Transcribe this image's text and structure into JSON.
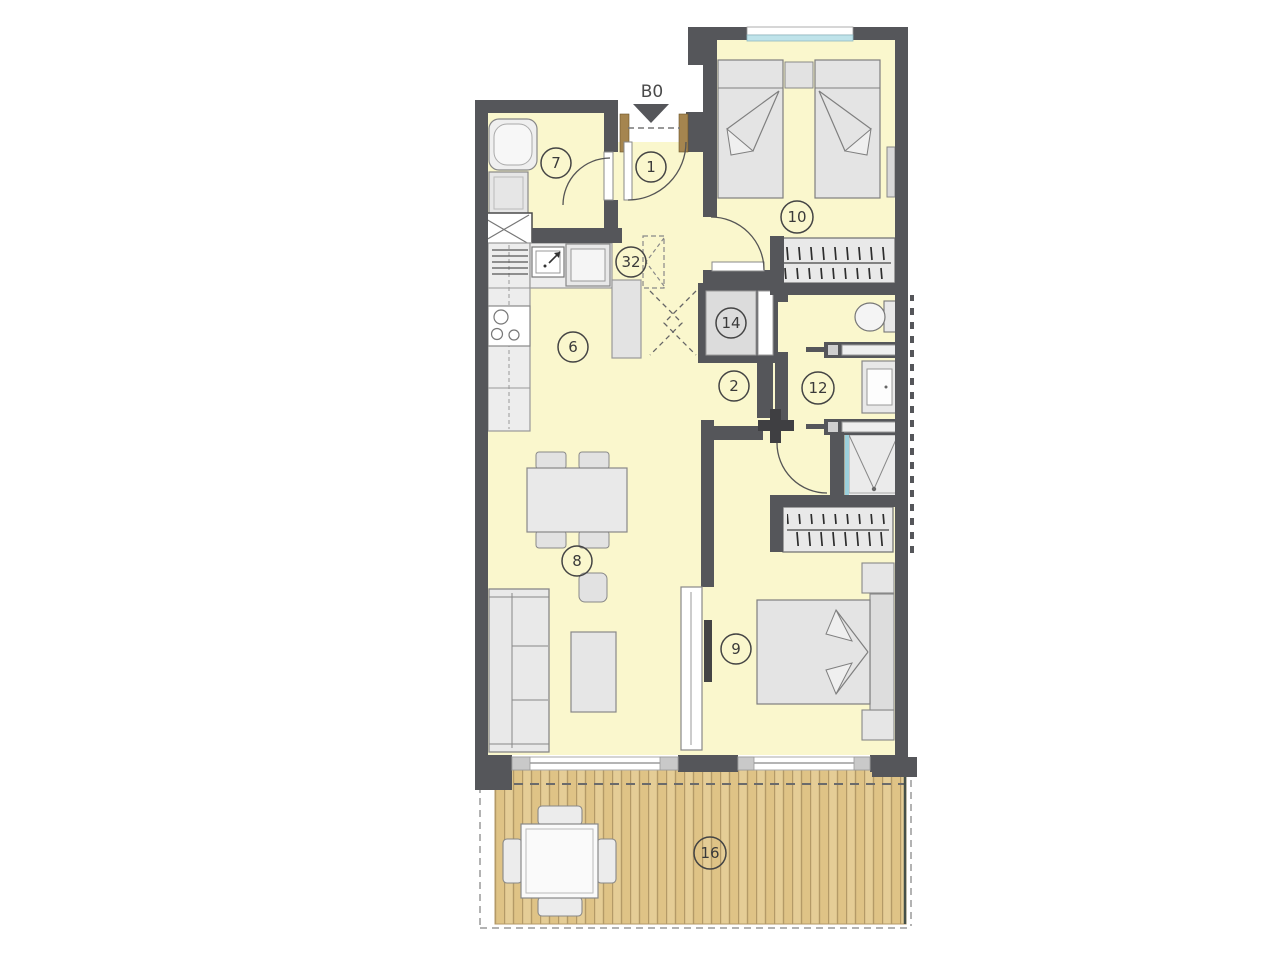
{
  "plan": {
    "entrance_label": "B0",
    "rooms": [
      {
        "id": "entry",
        "label": "1"
      },
      {
        "id": "hall",
        "label": "2"
      },
      {
        "id": "kitchen",
        "label": "6"
      },
      {
        "id": "bathroom-1",
        "label": "7"
      },
      {
        "id": "living-dining",
        "label": "8"
      },
      {
        "id": "bedroom-main",
        "label": "9"
      },
      {
        "id": "bedroom-twin",
        "label": "10"
      },
      {
        "id": "bathroom-2",
        "label": "12"
      },
      {
        "id": "utility",
        "label": "14"
      },
      {
        "id": "terrace",
        "label": "16"
      },
      {
        "id": "fridge-nook",
        "label": "32"
      }
    ],
    "colors": {
      "room_fill": "#FAF7CD",
      "wall": "#55565A",
      "furniture_fill": "#E6E6E6",
      "deck": "#E2C88E",
      "deck_stripe": "#B49A67",
      "window_glass": "#BFE3EA"
    }
  }
}
